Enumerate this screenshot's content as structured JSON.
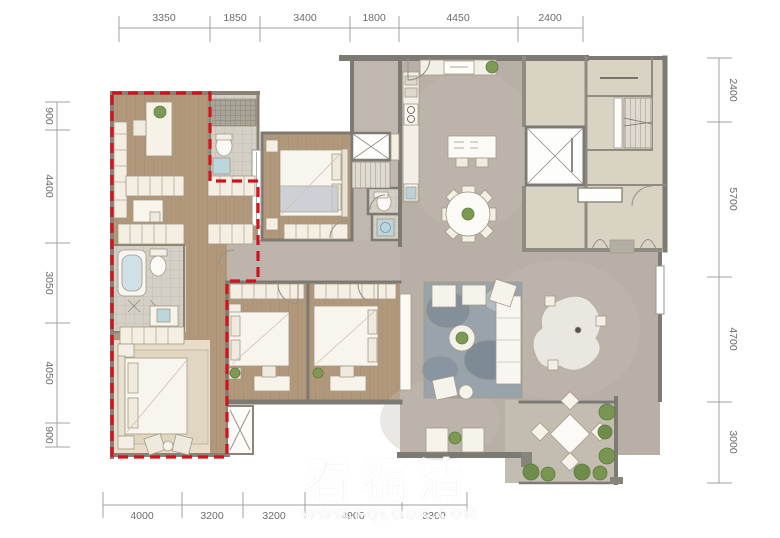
{
  "watermark": {
    "title": "看福清",
    "url": "WWW.FQLOOK.COM"
  },
  "dimensions": {
    "top": [
      "3350",
      "1850",
      "3400",
      "1800",
      "4450",
      "2400"
    ],
    "left": [
      "900",
      "4400",
      "3050",
      "4050",
      "900"
    ],
    "right": [
      "2400",
      "5700",
      "4700",
      "3000"
    ],
    "bottom": [
      "4000",
      "3200",
      "3200",
      "4900",
      "3300"
    ]
  },
  "colors": {
    "highlight_red": "#cf1420",
    "wood_floor": "#b1977a",
    "stone_floor": "#b7afa6",
    "neighbor_floor": "#d9d3c4",
    "wall_grey": "#7d7a73",
    "dim_line": "#a0a0a0"
  }
}
